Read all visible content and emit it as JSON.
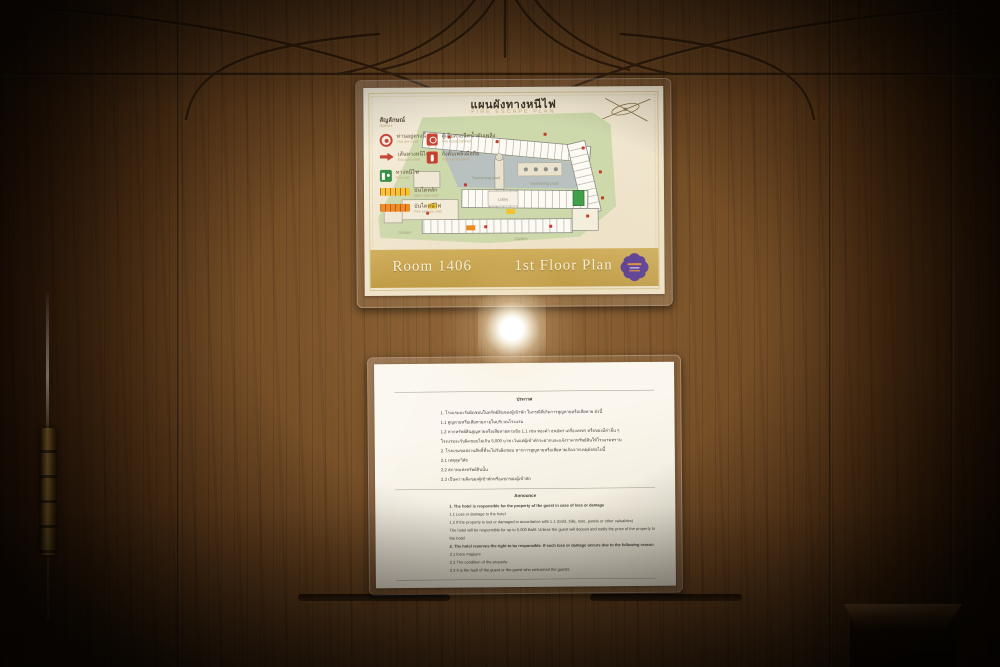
{
  "fire_plan": {
    "title_th": "แผนผังทางหนีไฟ",
    "title_en": "FIRE ESCAPE PLAN",
    "legend": {
      "heading_th": "สัญลักษณ์",
      "heading_en": "Symbol",
      "items": [
        {
          "icon": "you-are-here-icon",
          "label_th": "ท่านอยู่ตรงนี้",
          "label_en": "You are here"
        },
        {
          "icon": "fire-hose-cabinet-icon",
          "label_th": "ตู้เก็บสายฉีดน้ำดับเพลิง",
          "label_en": "Fire hose cabinet"
        },
        {
          "icon": "escape-route-arrow-icon",
          "label_th": "เส้นทางหนีไฟ",
          "label_en": "Escape route"
        },
        {
          "icon": "fire-extinguisher-icon",
          "label_th": "ถังดับเพลิงมือถือ",
          "label_en": "Fire extinguisher"
        },
        {
          "icon": "fire-exit-icon",
          "label_th": "ทางหนีไฟ",
          "label_en": "Fire exit"
        },
        {
          "icon": "main-staircase-marker",
          "label_th": "บันไดหลัก",
          "label_en": "Main staircase"
        },
        {
          "icon": "fire-staircase-marker",
          "label_th": "บันไดหนีไฟ",
          "label_en": "Fire escape stair"
        }
      ]
    },
    "map_labels": {
      "swimming_pool": "Swimming pool",
      "lobby": "Lobby",
      "garden": "Garden"
    },
    "footer": {
      "room": "Room 1406",
      "floor": "1st Floor Plan"
    }
  },
  "announcement": {
    "heading_th": "ประกาศ",
    "thai_lines": [
      "1. โรงแรมจะรับผิดชอบในทรัพย์สินของผู้เข้าพัก ในกรณีที่เกิดการสูญหายหรือเสียหาย ดังนี้",
      "1.1 สูญหายหรือเสียหายภายในบริเวณโรงแรม",
      "1.2 หากทรัพย์สินสูญหายหรือเสียหายตามข้อ 1.1 เช่น ทองคำ ธนบัตร เครื่องเพชร หรือของมีค่าอื่น ๆ",
      "โรงแรมจะรับผิดชอบไม่เกิน 5,000 บาท เว้นแต่ผู้เข้าพักจะฝากและแจ้งราคาทรัพย์สินให้โรงแรมทราบ",
      "2. โรงแรมขอสงวนสิทธิ์ที่จะไม่รับผิดชอบ หากการสูญหายหรือเสียหายเกิดจากเหตุดังต่อไปนี้",
      "2.1\tเหตุสุดวิสัย",
      "2.2\tสภาพแห่งทรัพย์สินนั้น",
      "2.3\tเป็นความผิดของผู้เข้าพักหรือแขกของผู้เข้าพัก"
    ],
    "heading_en": "Announce",
    "english_lines": [
      "1. The hotel is responsible for the property of the guest in case of loss or damage",
      "1.1 Loss or damage to the hotel",
      "1.2 If the property is lost or damaged in accordance with 1.1 (Gold, bills, note, jewels or other valuables)",
      "The hotel will be responsible for up to 5,000 Baht. Unless the guest will deposit and notify the price of the property to the hotel",
      "2. The hotel reserves the right to be responsible. If such loss or damage occurs due to the following reason",
      "2.1\tforce majeure",
      "2.2\tThe condition of the property",
      "2.3\tIt is the fault of the guest or the guest who welcomed the guests"
    ]
  },
  "colors": {
    "door_wood": "#5d3a1a",
    "gold_bar": "#c8a64e",
    "logo_purple": "#5b3e90",
    "paper_cream": "#f2e9d3",
    "paper_white": "#faf6ec",
    "exit_green": "#2f8a3c",
    "alert_red": "#c8402e",
    "stair_yellow": "#f2c331",
    "stair_orange": "#ea8c20",
    "map_garden": "#cdd8ab",
    "map_pool": "#b8c1bf"
  }
}
